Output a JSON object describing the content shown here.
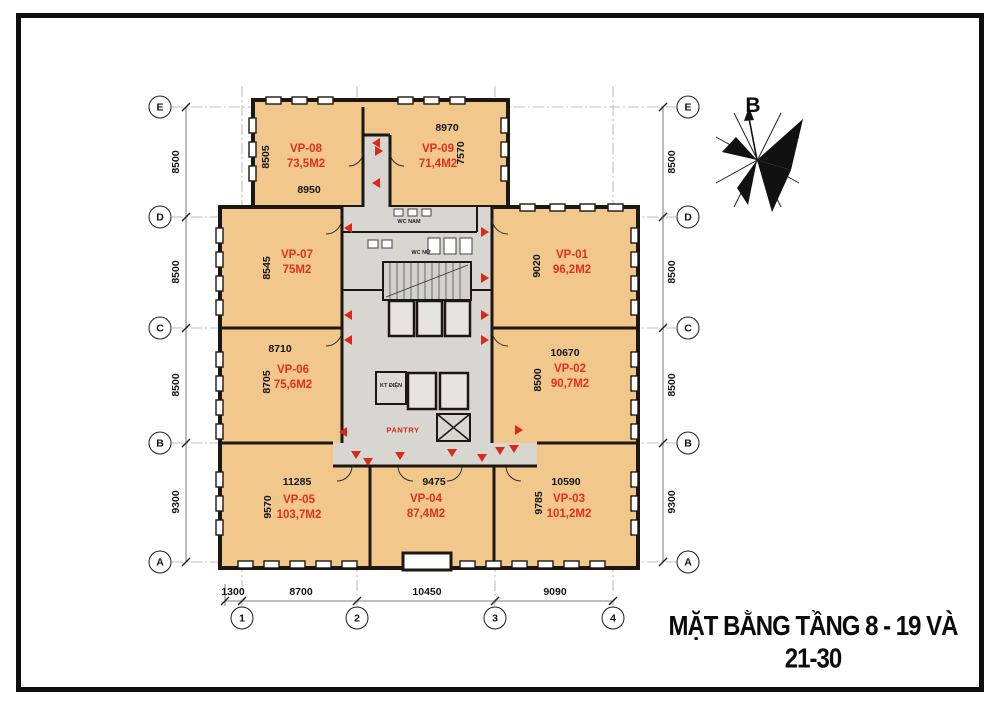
{
  "title": "MẶT BẰNG TẦNG 8 - 19 VÀ 21-30",
  "compass": {
    "label": "B"
  },
  "grid": {
    "rows": [
      "E",
      "D",
      "C",
      "B",
      "A"
    ],
    "cols": [
      "1",
      "2",
      "3",
      "4"
    ],
    "left_dims": [
      "8500",
      "8500",
      "8500",
      "9300"
    ],
    "right_dims": [
      "8500",
      "8500",
      "8500",
      "9300"
    ],
    "bottom_dims": [
      "1300",
      "8700",
      "10450",
      "9090"
    ]
  },
  "rooms": [
    {
      "id": "VP-08",
      "area": "73,5M2",
      "width_dim": "8950",
      "height_dim": "8505"
    },
    {
      "id": "VP-09",
      "area": "71,4M2",
      "width_dim": "8970",
      "height_dim": "7570"
    },
    {
      "id": "VP-07",
      "area": "75M2",
      "height_dim": "8545"
    },
    {
      "id": "VP-01",
      "area": "96,2M2",
      "height_dim": "9020"
    },
    {
      "id": "VP-06",
      "area": "75,6M2",
      "width_dim": "8710",
      "height_dim": "8705"
    },
    {
      "id": "VP-02",
      "area": "90,7M2",
      "width_dim": "10670",
      "height_dim": "8500"
    },
    {
      "id": "VP-05",
      "area": "103,7M2",
      "width_dim": "11285",
      "height_dim": "9570"
    },
    {
      "id": "VP-04",
      "area": "87,4M2",
      "width_dim": "9475"
    },
    {
      "id": "VP-03",
      "area": "101,2M2",
      "width_dim": "10590",
      "height_dim": "9785"
    }
  ],
  "core": {
    "wc_nam": "WC NAM",
    "wc_nu": "WC NỮ",
    "kt_dien": "KT ĐIỆN",
    "pantry": "PANTRY"
  },
  "colors": {
    "room_fill": "#f1c78c",
    "core_fill": "#d8d6d1",
    "wall": "#1d1712",
    "accent_red": "#d8291b"
  }
}
